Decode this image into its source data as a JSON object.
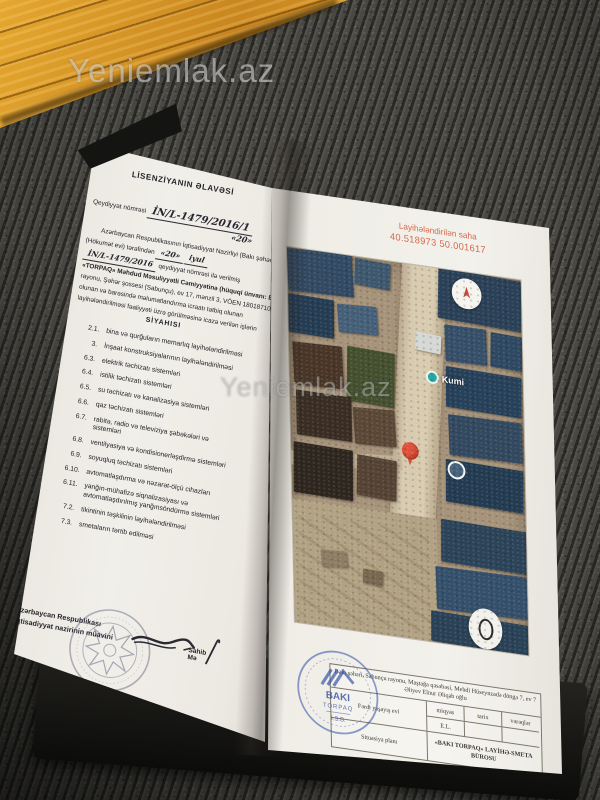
{
  "photo": {
    "watermark": "Yeniemlak.az"
  },
  "left_page": {
    "title": "LİSENZİYANIN ƏLAVƏSİ",
    "reg_label": "Qeydiyyat nömrəsi",
    "reg_number": "İN/L-1479/2016/1",
    "date_day": "«20»",
    "body": {
      "line1": "Azərbaycan Respublikasının İqtisadiyyat Nazirliyi (Bakı şəhəri, Ü.",
      "line2_text": "(Hökumət evi) tərəfindən",
      "line2_day": "«20»",
      "line2_month": "iyul",
      "line3_number": "İN/L-1479/2016",
      "line3_text": "qeydiyyat nömrəsi ilə verilmiş",
      "line4": "«TORPAQ» Məhdud Məsuliyyətli Cəmiyyətinə (hüquqi ünvanı: Bakı şəh.",
      "line5": "rayonu, Şəhər şossesi (Sabunçu), ev 17, mənzil 3, VÖEN 1801871001",
      "line6": "olunan və barəsində məlumatlandırma icraatı tətbiq olunan",
      "line7": "layihələndirilməsi fəaliyyəti üzrə görülməsinə icazə verilən işlərin"
    },
    "list_title": "SİYAHISI",
    "items": [
      {
        "no": "2.1.",
        "text": "bina və qurğuların memarlıq layihələndirilməsi"
      },
      {
        "no": "3.",
        "text": "İnşaat konstruksiyalarının layihələndirilməsi"
      },
      {
        "no": "6.3.",
        "text": "elektrik təchizatı sistemləri"
      },
      {
        "no": "6.4.",
        "text": "istilik təchizatı sistemləri"
      },
      {
        "no": "6.5.",
        "text": "su təchizatı və kanalizasiya sistemləri"
      },
      {
        "no": "6.6.",
        "text": "qaz təchizatı sistemləri"
      },
      {
        "no": "6.7.",
        "text": "rabitə, radio və televiziya şəbəkələri və sistemləri"
      },
      {
        "no": "6.8.",
        "text": "ventilyasiya və kondisionerləşdirmə sistemləri"
      },
      {
        "no": "6.9.",
        "text": "soyuqluq təchizatı sistemləri"
      },
      {
        "no": "6.10.",
        "text": "avtomatlaşdırma və nəzarət-ölçü cihazları"
      },
      {
        "no": "6.11.",
        "text": "yanğın-mühafizə siqnalizasiyası və avtomatlaşdırılmış yanğınsöndürmə sistemləri"
      },
      {
        "no": "7.2.",
        "text": "tikintinin təşkilinin layihələndirilməsi"
      },
      {
        "no": "7.3.",
        "text": "smetaların tərtib edilməsi"
      }
    ],
    "signatory": {
      "line1": "Azərbaycan Respublikası",
      "line2": "iqtisadiyyat nazirinin müavini",
      "name": "Sahib Mə"
    }
  },
  "right_page": {
    "site_label": {
      "line1": "Layihələndirilən saha",
      "line2": "40.518973 50.001617"
    },
    "map": {
      "place": "Kumi"
    },
    "title_block": {
      "address": "Bakı şəhəri, Sabunçu rayonu, Maştağa qəsəbəsi, Mehdi Hüseynzadə döngə 7, ev 7",
      "owner": "Əliyev Elnur Əliqab oğlu",
      "object": "Fərdi yaşayış evi",
      "col_scale": "miqyas",
      "col_date": "tarix",
      "col_sheets": "vərəqlər",
      "scale_value": "E.L.",
      "row_plan": "Situasiya planı",
      "bureau_line1": "«BAKI TORPAQ» LAYİHƏ-SMETA",
      "bureau_line2": "BÜROSU"
    },
    "stamp": {
      "line1": "BAKI",
      "line2": "TORPAQ",
      "line3": "İ.S.B."
    }
  },
  "colors": {
    "site_label_red": "#d4694b",
    "pin_red": "#e0523a",
    "place_teal": "#23a69e",
    "stamp_blue": "#3450a6",
    "wood_orange": "#d9992a"
  }
}
